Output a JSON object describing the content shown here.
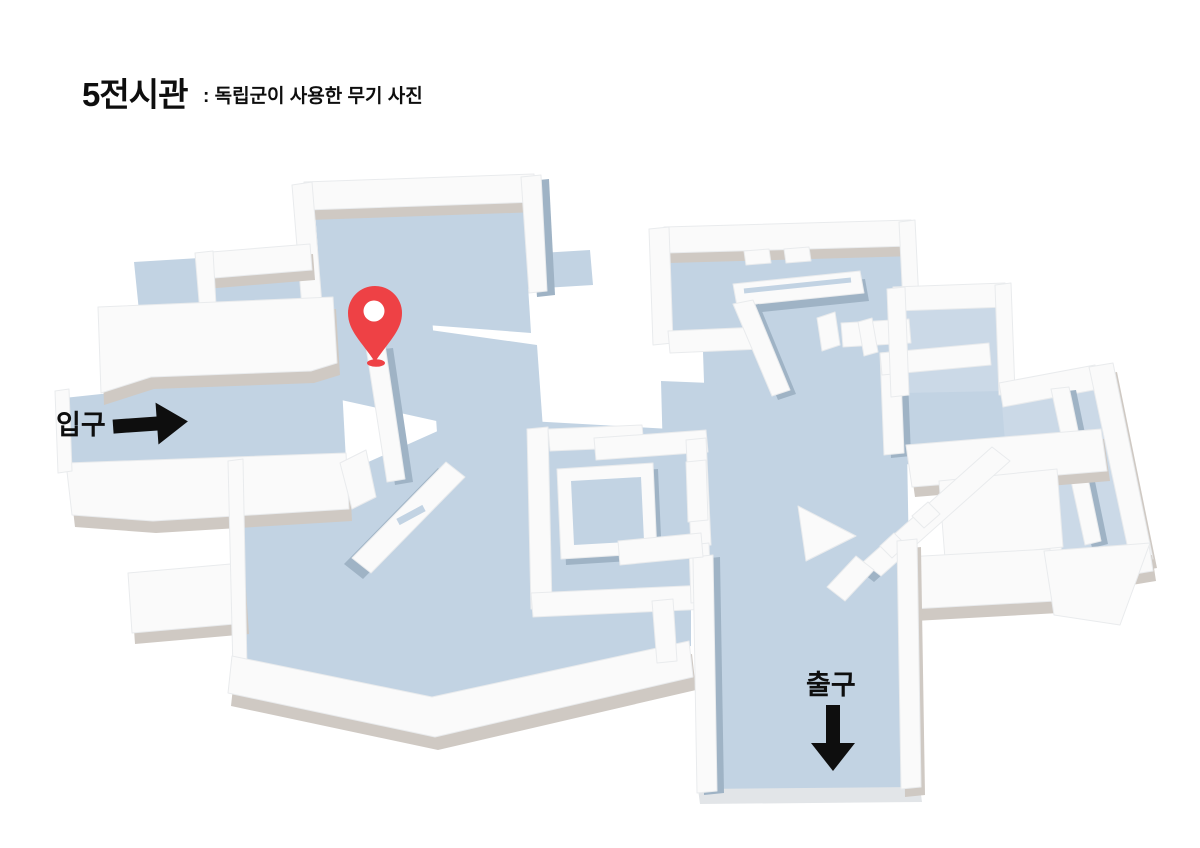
{
  "header": {
    "title": "5전시관",
    "subtitle": ": 독립군이 사용한 무기 사진"
  },
  "map": {
    "entrance_label": "입구",
    "exit_label": "출구",
    "icons": [
      "location-pin-icon",
      "entrance-arrow-right-icon",
      "exit-arrow-down-icon"
    ]
  },
  "colors": {
    "background": "#ffffff",
    "floor": "#c2d3e3",
    "floor_light": "#cbd9e7",
    "wall_top": "#fafafa",
    "wall_stroke": "#e9ebed",
    "side_warm": "#cfc9c3",
    "side_cool": "#9fb3c5",
    "side_light": "#e2e5e8",
    "pin_red": "#ee4145",
    "ink": "#0e0e0e"
  }
}
